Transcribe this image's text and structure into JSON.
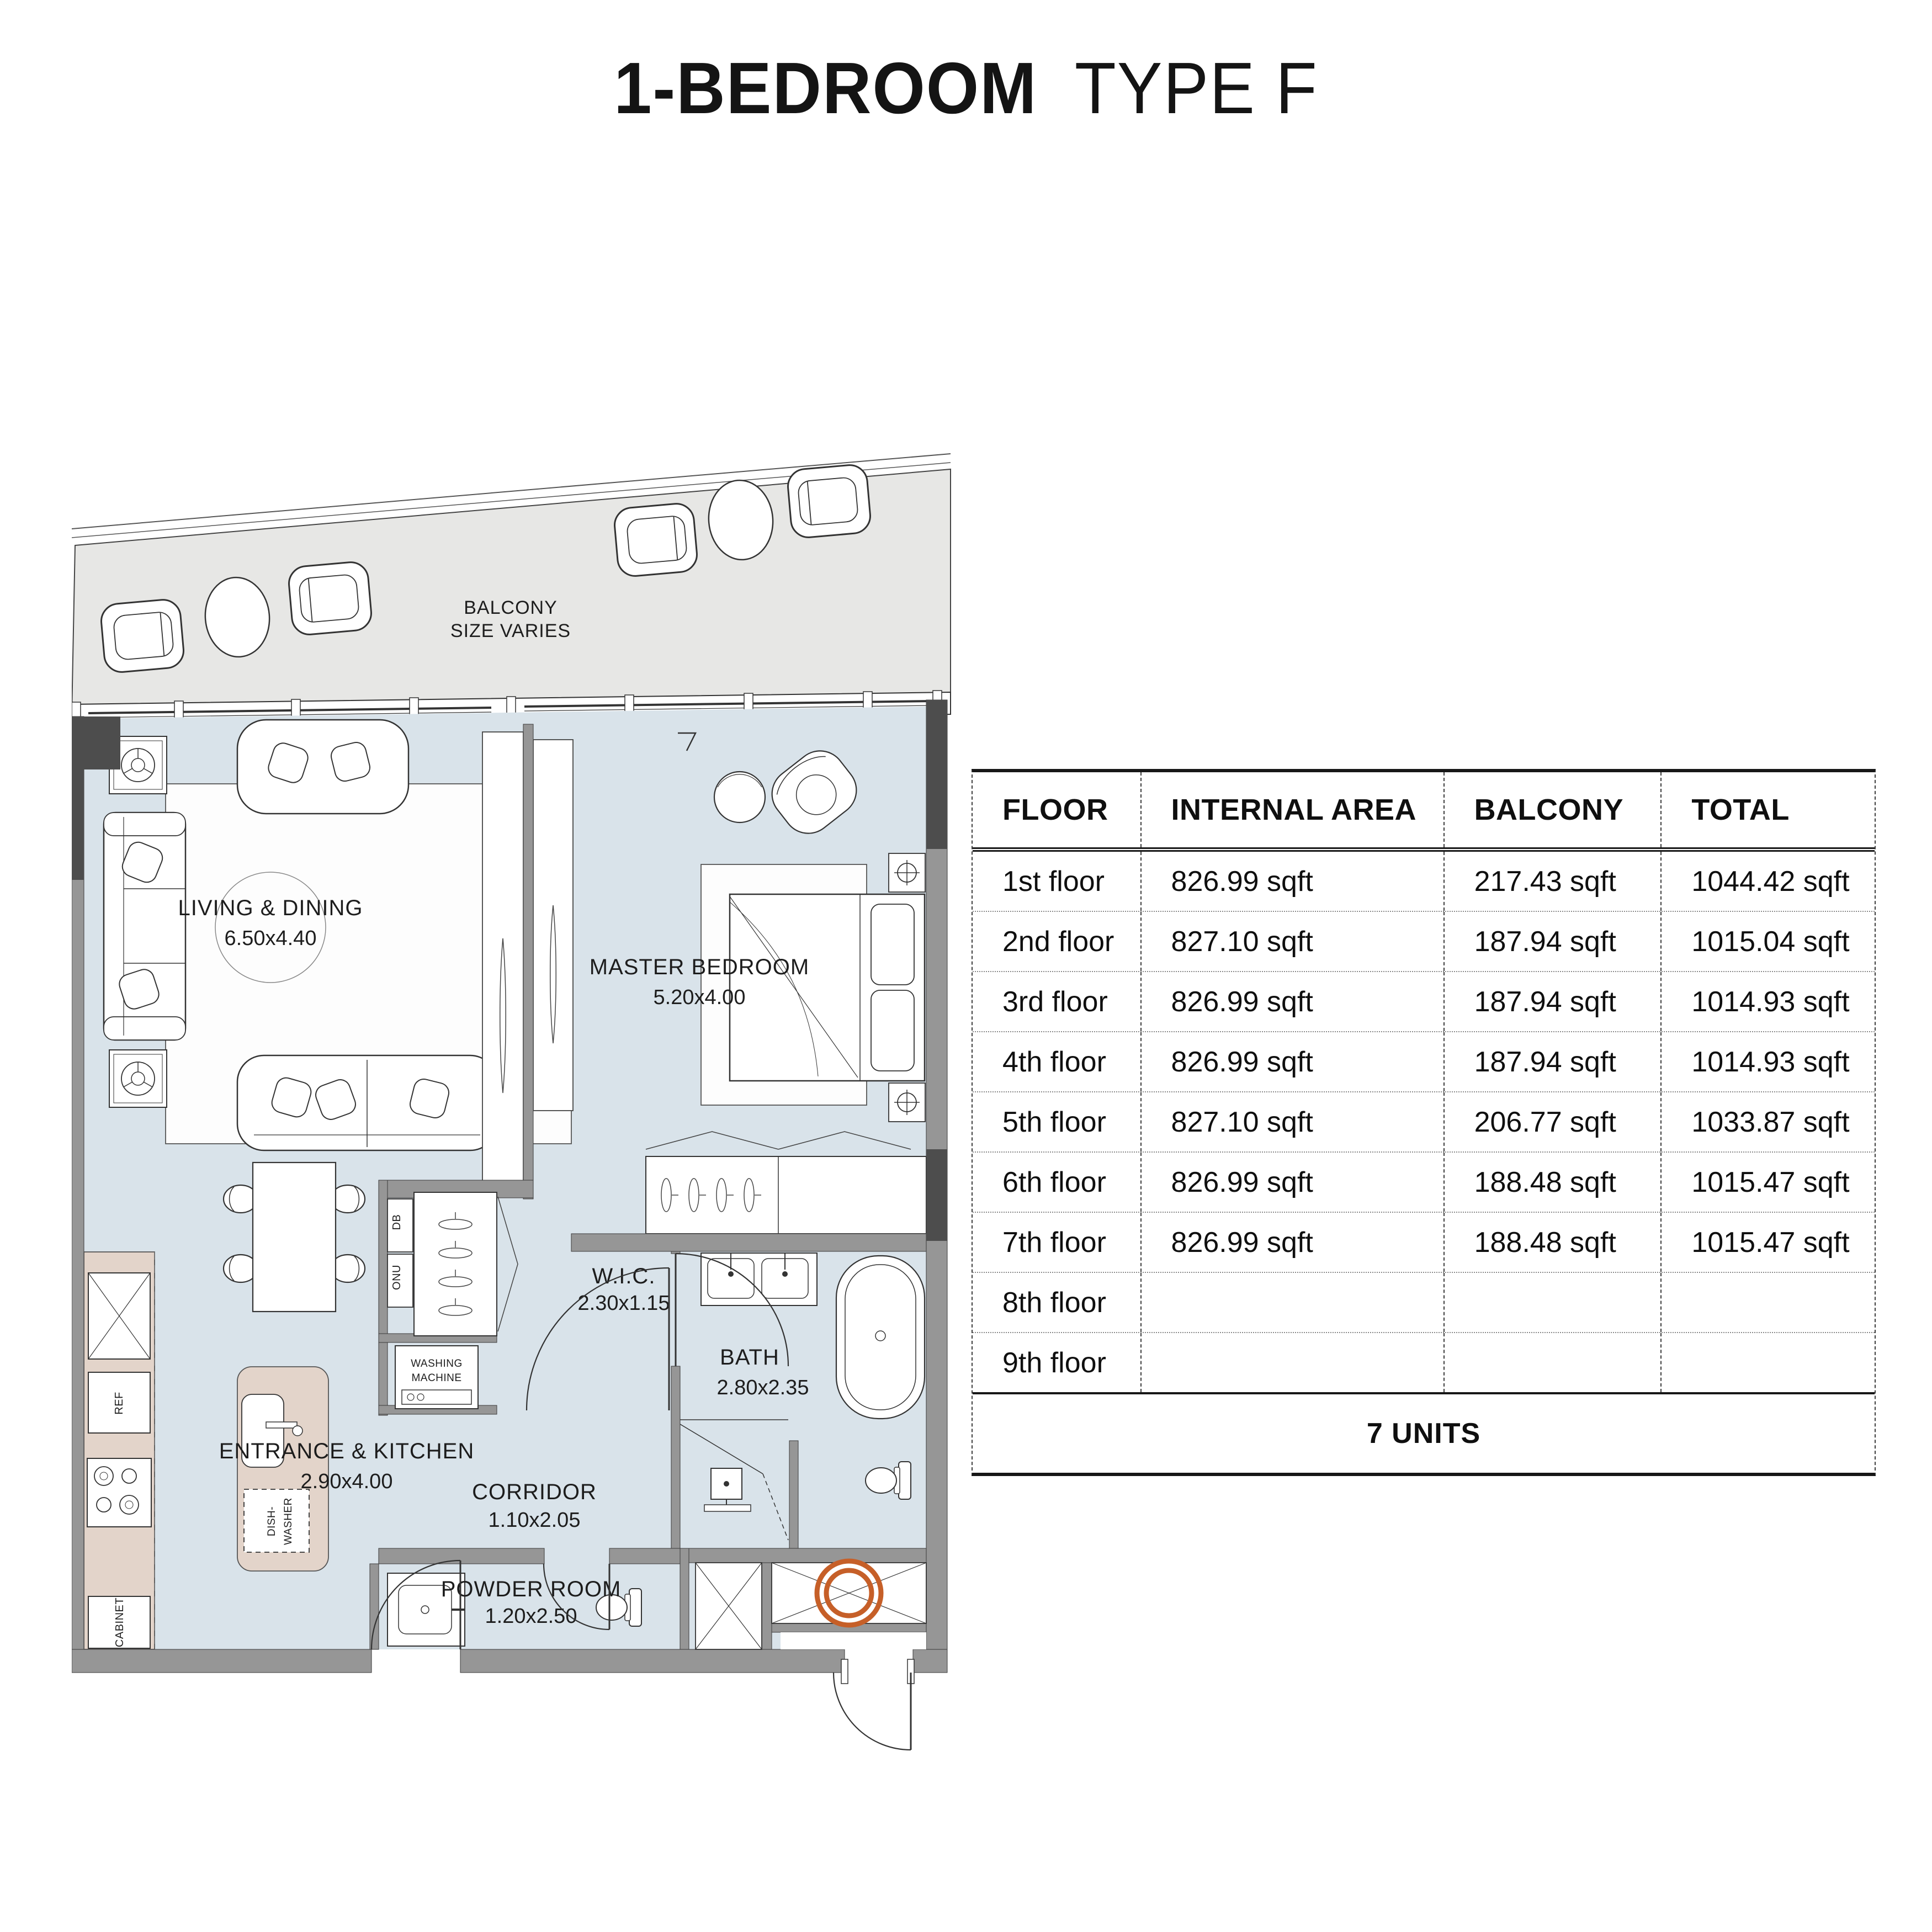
{
  "title": {
    "primary": "1-BEDROOM",
    "secondary": "TYPE F"
  },
  "floor_plan": {
    "balcony": {
      "label_line1": "BALCONY",
      "label_line2": "SIZE VARIES"
    },
    "rooms": [
      {
        "name": "LIVING & DINING",
        "dimensions": "6.50x4.40"
      },
      {
        "name": "MASTER BEDROOM",
        "dimensions": "5.20x4.00"
      },
      {
        "name": "W.I.C.",
        "dimensions": "2.30x1.15"
      },
      {
        "name": "BATH",
        "dimensions": "2.80x2.35"
      },
      {
        "name": "CORRIDOR",
        "dimensions": "1.10x2.05"
      },
      {
        "name": "ENTRANCE & KITCHEN",
        "dimensions": "2.90x4.00"
      },
      {
        "name": "POWDER ROOM",
        "dimensions": "1.20x2.50"
      }
    ],
    "fixtures": {
      "washing_machine_line1": "WASHING",
      "washing_machine_line2": "MACHINE",
      "ref": "REF",
      "cabinet": "CABINET",
      "db": "DB",
      "onu": "ONU",
      "dishwasher_line1": "DISH-",
      "dishwasher_line2": "WASHER"
    }
  },
  "area_table": {
    "headers": [
      "FLOOR",
      "INTERNAL AREA",
      "BALCONY",
      "TOTAL"
    ],
    "rows": [
      {
        "floor": "1st floor",
        "internal_area": "826.99 sqft",
        "balcony": "217.43 sqft",
        "total": "1044.42 sqft"
      },
      {
        "floor": "2nd floor",
        "internal_area": "827.10 sqft",
        "balcony": "187.94 sqft",
        "total": "1015.04 sqft"
      },
      {
        "floor": "3rd floor",
        "internal_area": "826.99 sqft",
        "balcony": "187.94 sqft",
        "total": "1014.93 sqft"
      },
      {
        "floor": "4th floor",
        "internal_area": "826.99 sqft",
        "balcony": "187.94 sqft",
        "total": "1014.93 sqft"
      },
      {
        "floor": "5th floor",
        "internal_area": "827.10 sqft",
        "balcony": "206.77 sqft",
        "total": "1033.87 sqft"
      },
      {
        "floor": "6th floor",
        "internal_area": "826.99 sqft",
        "balcony": "188.48 sqft",
        "total": "1015.47 sqft"
      },
      {
        "floor": "7th floor",
        "internal_area": "826.99 sqft",
        "balcony": "188.48 sqft",
        "total": "1015.47 sqft"
      },
      {
        "floor": "8th floor",
        "internal_area": "",
        "balcony": "",
        "total": ""
      },
      {
        "floor": "9th floor",
        "internal_area": "",
        "balcony": "",
        "total": ""
      }
    ],
    "footer": "7 UNITS"
  },
  "colors": {
    "floor": "#d9e3ea",
    "balcony-floor": "#e7e7e5",
    "wall": "#969696",
    "wall-dark": "#4d4d4d",
    "counter": "#e3d4ca",
    "accent-orange": "#c65f28"
  }
}
